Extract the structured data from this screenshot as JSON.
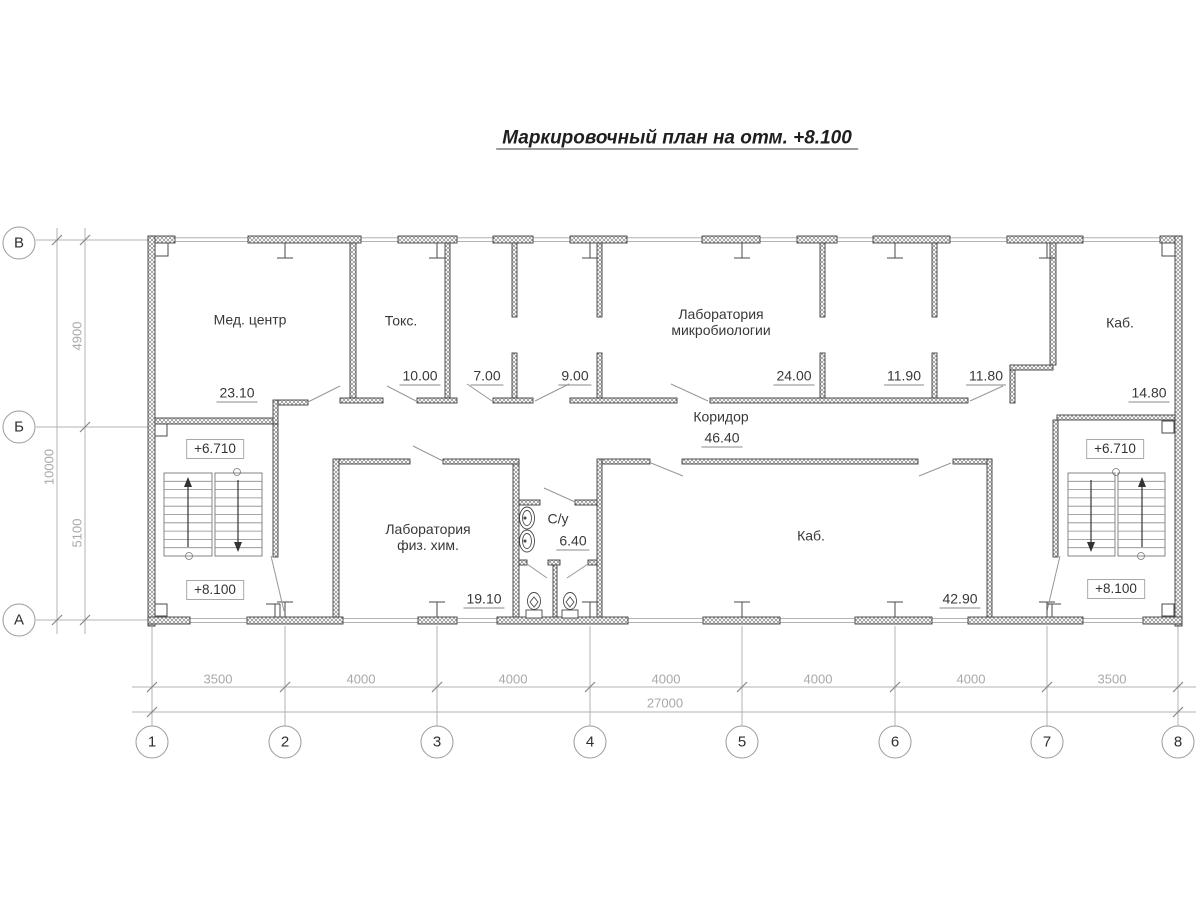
{
  "title": "Маркировочный план на отм. +8.100",
  "axes": {
    "vertical": [
      "В",
      "Б",
      "А"
    ],
    "horizontal": [
      "1",
      "2",
      "3",
      "4",
      "5",
      "6",
      "7",
      "8"
    ]
  },
  "dimensions": {
    "bottom_segments": [
      "3500",
      "4000",
      "4000",
      "4000",
      "4000",
      "4000",
      "3500"
    ],
    "bottom_total": "27000",
    "left_segments": [
      "4900",
      "5100"
    ],
    "left_total": "10000"
  },
  "rooms": {
    "med_center": {
      "name": "Мед. центр",
      "area": "23.10"
    },
    "toxicology": {
      "name": "Токс.",
      "area": "10.00"
    },
    "room_7": {
      "area": "7.00"
    },
    "room_9": {
      "area": "9.00"
    },
    "microbiology_lab": {
      "name_line1": "Лаборатория",
      "name_line2": "микробиологии",
      "area": "24.00"
    },
    "room_11_90": {
      "area": "11.90"
    },
    "room_11_80": {
      "area": "11.80"
    },
    "office_right": {
      "name": "Каб.",
      "area": "14.80"
    },
    "corridor": {
      "name": "Коридор",
      "area": "46.40"
    },
    "phys_chem_lab": {
      "name_line1": "Лаборатория",
      "name_line2": "физ. хим.",
      "area": "19.10"
    },
    "sanitary": {
      "name": "С/у",
      "area": "6.40"
    },
    "office_center": {
      "name": "Каб.",
      "area": "42.90"
    }
  },
  "levels": {
    "left_upper": "+6.710",
    "left_lower": "+8.100",
    "right_upper": "+6.710",
    "right_lower": "+8.100"
  }
}
